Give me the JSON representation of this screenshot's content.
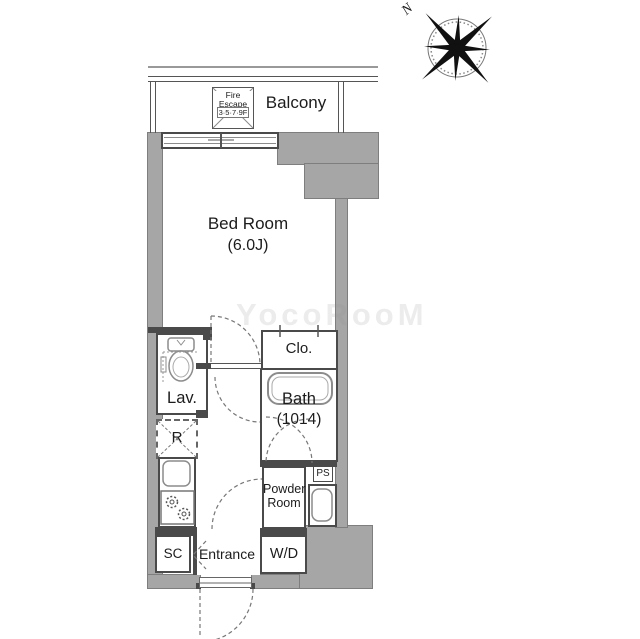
{
  "compass": {
    "north": "N"
  },
  "balcony": {
    "label": "Balcony",
    "fire_escape_line1": "Fire",
    "fire_escape_line2": "Escape",
    "fire_escape_line3": "3·5·7·9F"
  },
  "rooms": {
    "bedroom_name": "Bed Room",
    "bedroom_size": "(6.0J)",
    "closet": "Clo.",
    "bath_name": "Bath",
    "bath_size": "(1014)",
    "lavatory": "Lav.",
    "refrigerator": "R",
    "powder_line1": "Powder",
    "powder_line2": "Room",
    "washer_dryer": "W/D",
    "shoe_closet": "SC",
    "entrance": "Entrance",
    "pipe_space": "PS"
  },
  "watermark": "YocoRooM",
  "colors": {
    "wall_fill": "#a6a6a6",
    "wall_line": "#4a4a4a",
    "fixture_line": "#8c8c8c",
    "text": "#1c1c1c"
  }
}
